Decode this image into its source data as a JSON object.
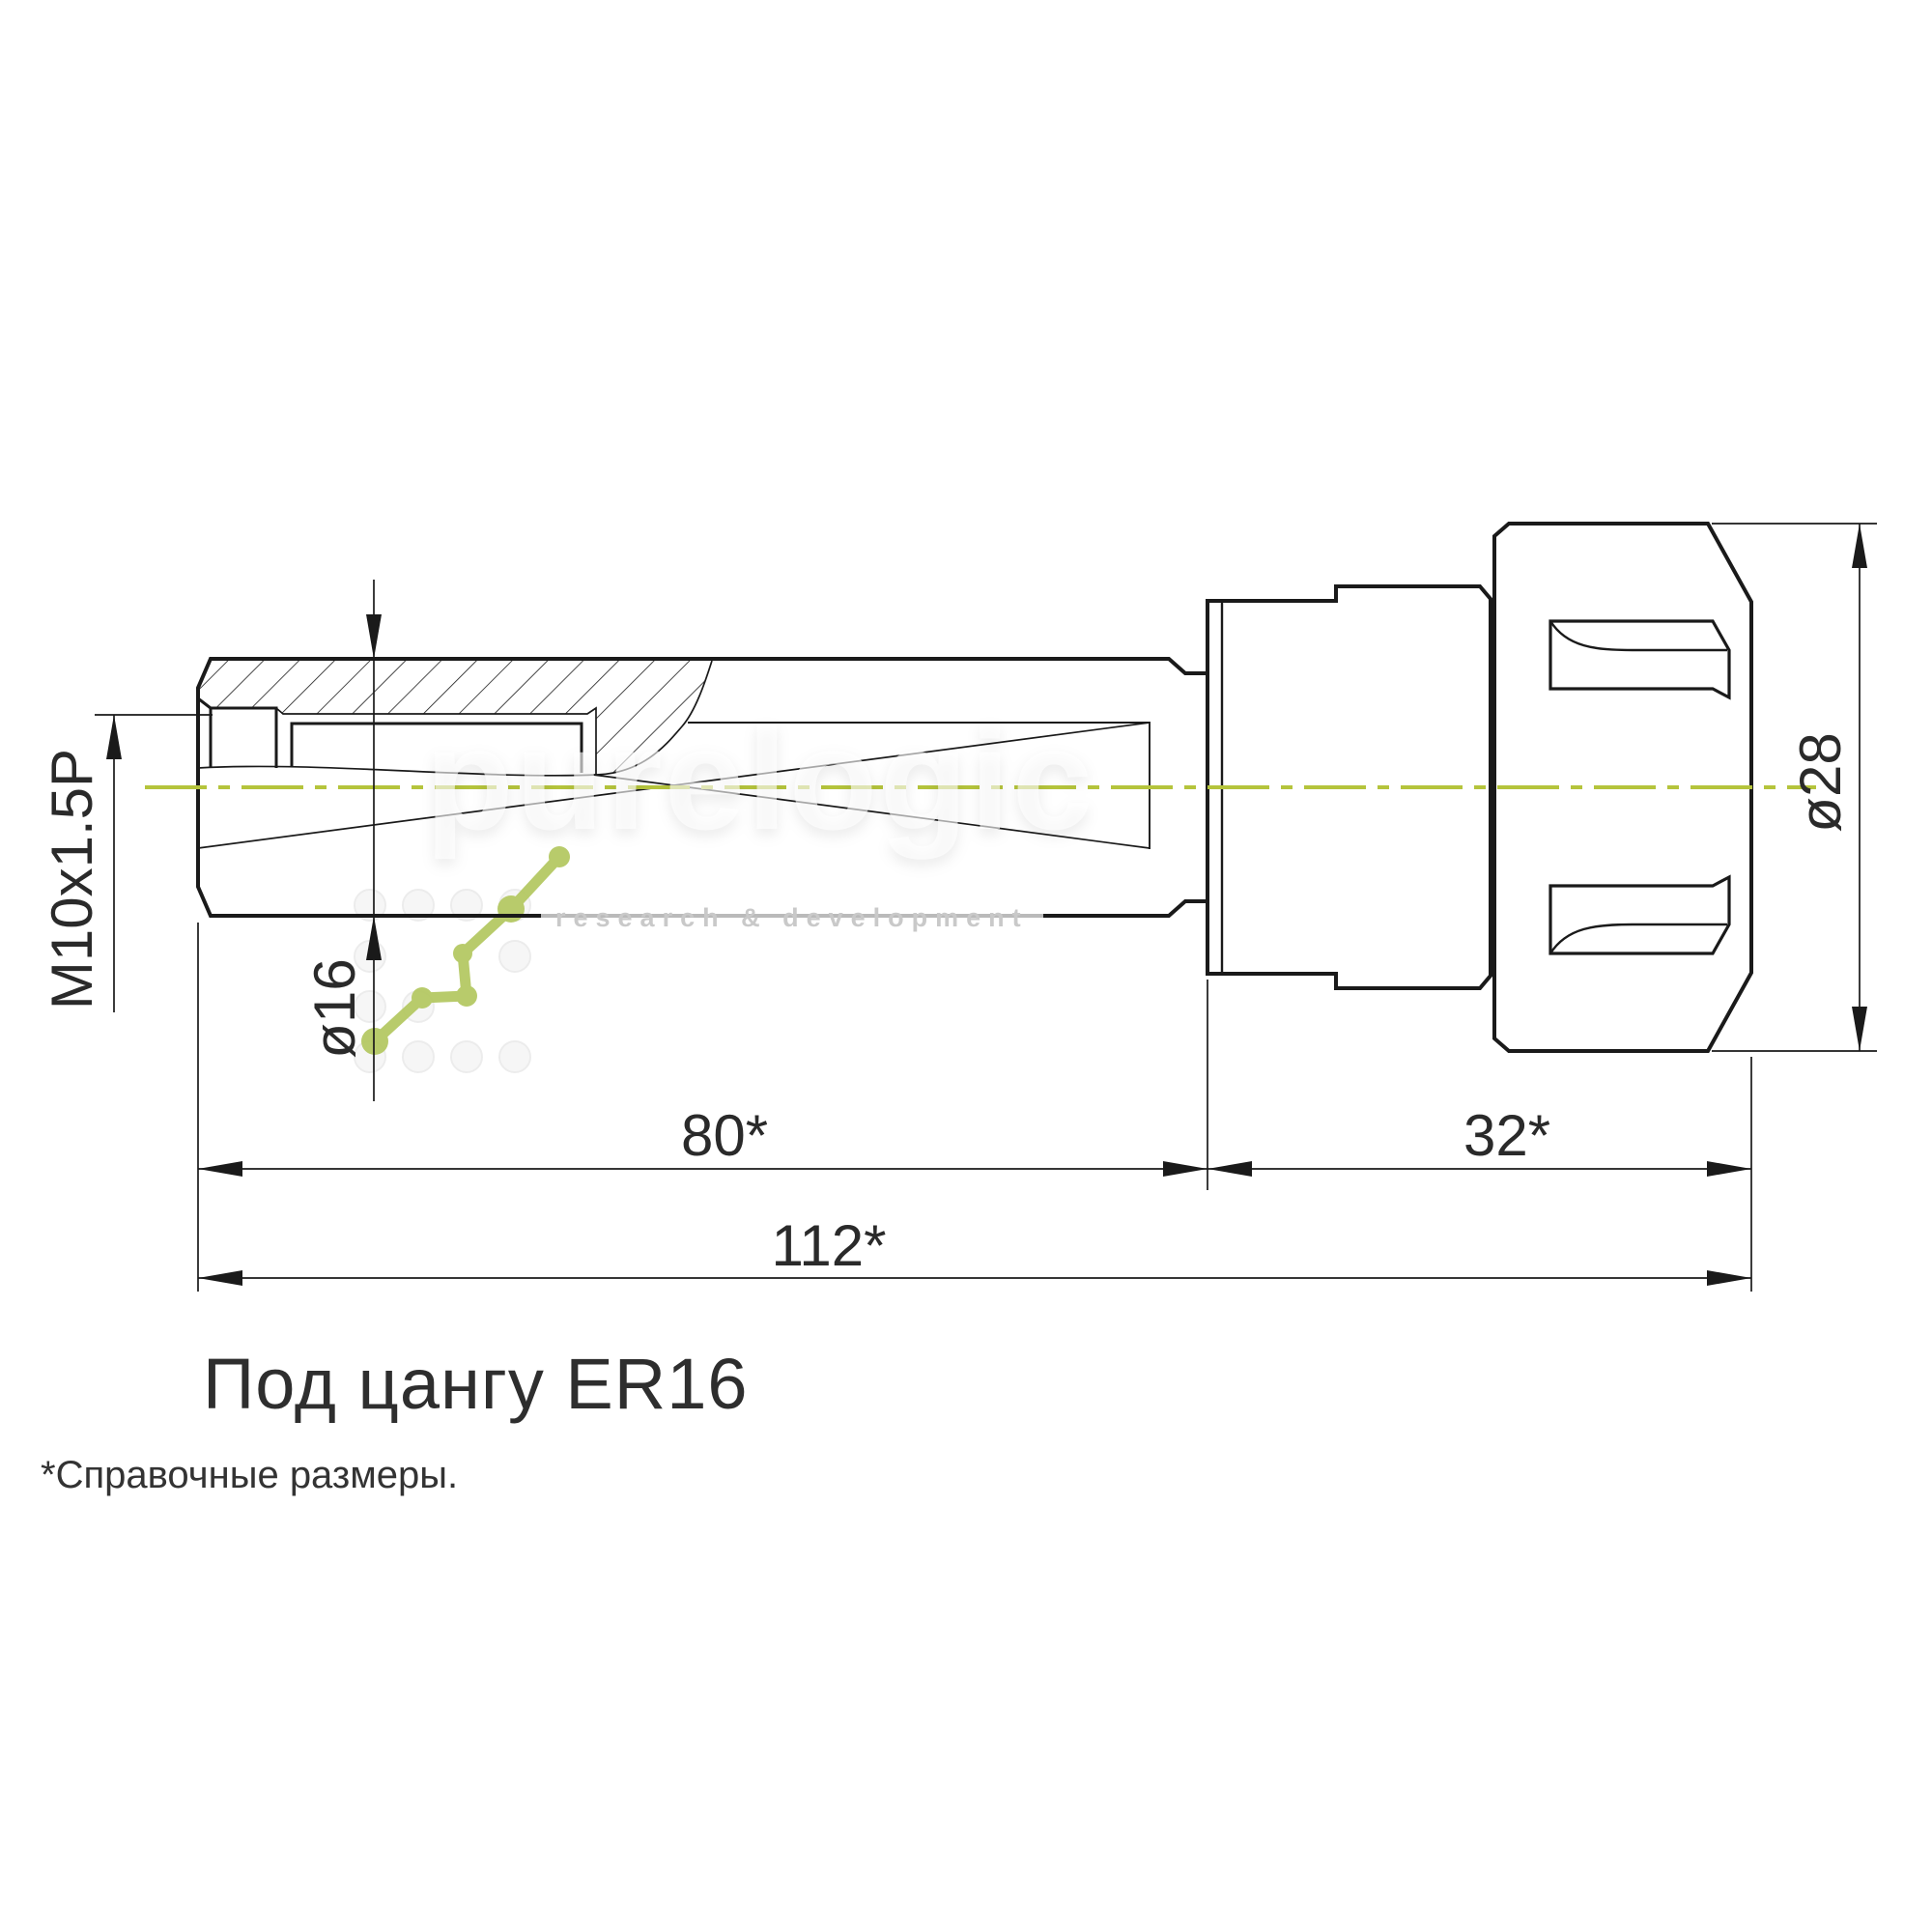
{
  "dims": {
    "m10": "M10x1.5P",
    "d16": "ø16",
    "len80": "80*",
    "len32": "32*",
    "len112": "112*",
    "d28": "ø28"
  },
  "notes": {
    "collet": "Под цангу ER16",
    "footnote": "*Справочные размеры."
  },
  "watermark": {
    "brand": "purelogic",
    "tagline": "research & development"
  },
  "colors": {
    "line": "#1a1a1a",
    "centerline": "#b5c43c",
    "logo_green": "#b5c964"
  }
}
